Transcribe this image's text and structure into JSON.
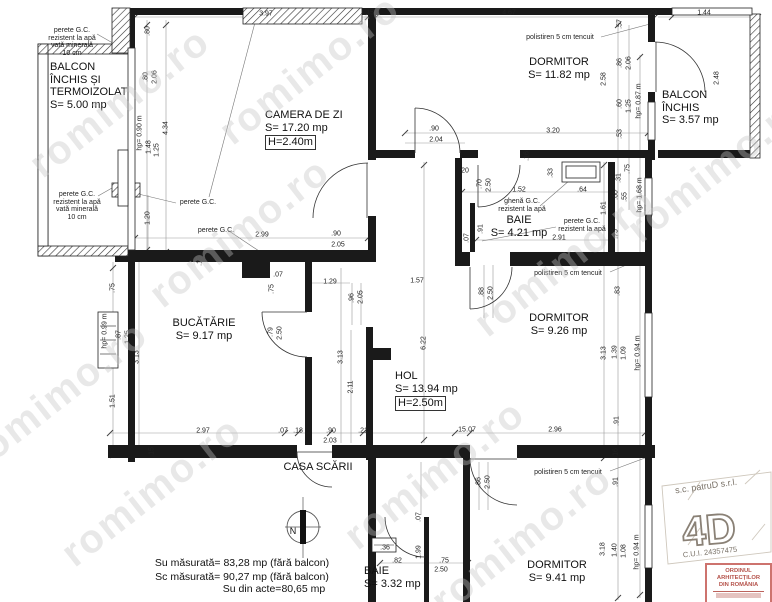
{
  "plan": {
    "watermark": "romimo.ro",
    "compass_label": "N",
    "summary": [
      "Su măsurată= 83,28 mp (fără balcon)",
      "Sc măsurată= 90,27 mp (fără balcon)",
      "Su din acte=80,65 mp"
    ],
    "stamp": {
      "company": "s.c. patruD s.r.l.",
      "logo": "4D",
      "cui": "C.U.I. 24357475",
      "seal_line1": "ORDINUL ARHITECȚILOR",
      "seal_line2": "DIN ROMÂNIA",
      "seal_color": "#b5524a"
    },
    "rooms": [
      {
        "id": "balcon-stanga",
        "lines": [
          "BALCON",
          "ÎNCHIS ȘI",
          "TERMOIZOLAT",
          "S= 5.00 mp"
        ],
        "x": 50,
        "y": 61,
        "align": "left"
      },
      {
        "id": "camera-de-zi",
        "lines": [
          "CAMERA DE ZI",
          "S= 17.20 mp"
        ],
        "boxed": "H=2.40m",
        "x": 265,
        "y": 109,
        "align": "left"
      },
      {
        "id": "dormitor-1",
        "lines": [
          "DORMITOR",
          "S= 11.82 mp"
        ],
        "x": 559,
        "y": 56
      },
      {
        "id": "balcon-dreapta",
        "lines": [
          "BALCON",
          "ÎNCHIS",
          "S= 3.57 mp"
        ],
        "x": 662,
        "y": 89,
        "align": "left"
      },
      {
        "id": "baie-1",
        "lines": [
          "BAIE",
          "S= 4.21 mp"
        ],
        "x": 519,
        "y": 214
      },
      {
        "id": "bucatarie",
        "lines": [
          "BUCĂTĂRIE",
          "S= 9.17 mp"
        ],
        "x": 204,
        "y": 317
      },
      {
        "id": "hol",
        "lines": [
          "HOL",
          "S= 13.94 mp"
        ],
        "boxed": "H=2.50m",
        "x": 395,
        "y": 370,
        "align": "left"
      },
      {
        "id": "dormitor-2",
        "lines": [
          "DORMITOR",
          "S= 9.26 mp"
        ],
        "x": 559,
        "y": 312
      },
      {
        "id": "casa-scarii",
        "lines": [
          "CASA SCĂRII"
        ],
        "x": 318,
        "y": 461
      },
      {
        "id": "baie-2",
        "lines": [
          "BAIE",
          "S= 3.32 mp"
        ],
        "x": 364,
        "y": 565,
        "align": "left"
      },
      {
        "id": "dormitor-3",
        "lines": [
          "DORMITOR",
          "S= 9.41 mp"
        ],
        "x": 557,
        "y": 559
      }
    ],
    "notes": [
      {
        "lines": [
          "perete G.C.",
          "rezistent la apă",
          "vată minerală",
          "10 cm"
        ],
        "x": 72,
        "y": 27
      },
      {
        "lines": [
          "perete G.C.",
          "rezistent la apă",
          "vată minerală",
          "10 cm"
        ],
        "x": 77,
        "y": 191
      },
      {
        "lines": [
          "perete G.C."
        ],
        "x": 198,
        "y": 199
      },
      {
        "lines": [
          "perete G.C."
        ],
        "x": 216,
        "y": 227
      },
      {
        "lines": [
          "polistiren 5 cm tencuit"
        ],
        "x": 560,
        "y": 34
      },
      {
        "lines": [
          "ghenă G.C.",
          "rezistent la apă"
        ],
        "x": 522,
        "y": 198
      },
      {
        "lines": [
          "perete G.C.",
          "rezistent la apă"
        ],
        "x": 582,
        "y": 218
      },
      {
        "lines": [
          "polistiren 5 cm tencuit"
        ],
        "x": 568,
        "y": 270
      },
      {
        "lines": [
          "polistiren 5 cm tencuit"
        ],
        "x": 568,
        "y": 469
      }
    ],
    "dims": [
      [
        "3.97",
        266,
        14,
        0
      ],
      [
        ".15",
        369,
        13,
        0
      ],
      [
        "4.67",
        509,
        13,
        0
      ],
      [
        ".29",
        652,
        13,
        0
      ],
      [
        "1.44",
        704,
        13,
        0
      ],
      [
        ".57",
        620,
        24,
        1
      ],
      [
        "2.48",
        717,
        78,
        1
      ],
      [
        ".80",
        148,
        31,
        1
      ],
      [
        ".80",
        146,
        77,
        1
      ],
      [
        "2.06",
        155,
        77,
        1
      ],
      [
        "hp= 0.90 m",
        140,
        133,
        1
      ],
      [
        "1.48",
        149,
        147,
        1
      ],
      [
        "1.25",
        157,
        150,
        1
      ],
      [
        "4.34",
        166,
        128,
        1
      ],
      [
        "2.58",
        604,
        79,
        1
      ],
      [
        ".86",
        620,
        63,
        1
      ],
      [
        "2.06",
        629,
        63,
        1
      ],
      [
        ".60",
        620,
        104,
        1
      ],
      [
        "1.25",
        629,
        106,
        1
      ],
      [
        ".53",
        620,
        134,
        1
      ],
      [
        "hp= 0.87 m",
        639,
        101,
        1
      ],
      [
        ".90",
        434,
        129,
        0
      ],
      [
        "2.04",
        436,
        140,
        0
      ],
      [
        "3.20",
        553,
        131,
        0
      ],
      [
        ".16",
        527,
        156,
        1
      ],
      [
        ".75",
        628,
        169,
        1
      ],
      [
        ".31",
        619,
        178,
        1
      ],
      [
        ".60",
        616,
        195,
        1
      ],
      [
        ".55",
        625,
        197,
        1
      ],
      [
        "hp= 1.68 m",
        640,
        195,
        1
      ],
      [
        ".20",
        464,
        171,
        0
      ],
      [
        ".70",
        480,
        184,
        1
      ],
      [
        "2.50",
        489,
        185,
        1
      ],
      [
        "1.52",
        519,
        190,
        0
      ],
      [
        ".64",
        582,
        190,
        0
      ],
      [
        ".33",
        551,
        173,
        1
      ],
      [
        "1.61",
        604,
        208,
        1
      ],
      [
        ".91",
        481,
        229,
        1
      ],
      [
        ".07",
        467,
        238,
        1
      ],
      [
        "2.91",
        559,
        238,
        0
      ],
      [
        ".75",
        616,
        234,
        1
      ],
      [
        "2.99",
        262,
        235,
        0
      ],
      [
        ".90",
        336,
        234,
        0
      ],
      [
        "2.05",
        338,
        245,
        0
      ],
      [
        ".15",
        200,
        261,
        1
      ],
      [
        "1.20",
        148,
        218,
        1
      ],
      [
        ".75",
        113,
        288,
        1
      ],
      [
        ".87",
        119,
        335,
        1
      ],
      [
        "1.25",
        128,
        337,
        1
      ],
      [
        "hp= 0.99 m",
        105,
        331,
        1
      ],
      [
        "3.13",
        137,
        357,
        1
      ],
      [
        "1.51",
        113,
        401,
        1
      ],
      [
        ".07",
        278,
        275,
        0
      ],
      [
        ".75",
        272,
        289,
        1
      ],
      [
        ".79",
        271,
        332,
        1
      ],
      [
        "2.50",
        280,
        333,
        1
      ],
      [
        "1.29",
        330,
        282,
        0
      ],
      [
        "1.57",
        417,
        281,
        0
      ],
      [
        ".96",
        352,
        298,
        1
      ],
      [
        "2.05",
        361,
        297,
        1
      ],
      [
        "6.22",
        424,
        343,
        1
      ],
      [
        "3.13",
        341,
        357,
        1
      ],
      [
        "2.11",
        351,
        387,
        1
      ],
      [
        ".88",
        482,
        292,
        1
      ],
      [
        "2.50",
        491,
        293,
        1
      ],
      [
        ".83",
        618,
        291,
        1
      ],
      [
        "3.13",
        604,
        353,
        1
      ],
      [
        "1.39",
        615,
        352,
        1
      ],
      [
        "1.09",
        624,
        353,
        1
      ],
      [
        "hp= 0.94 m",
        638,
        353,
        1
      ],
      [
        ".91",
        617,
        421,
        1
      ],
      [
        "2.96",
        555,
        430,
        0
      ],
      [
        ".15",
        461,
        430,
        0
      ],
      [
        ".07",
        471,
        430,
        0
      ],
      [
        ".16",
        616,
        453,
        1
      ],
      [
        "2.97",
        203,
        431,
        0
      ],
      [
        ".07",
        283,
        431,
        0
      ],
      [
        ".18",
        298,
        431,
        0
      ],
      [
        ".90",
        331,
        431,
        0
      ],
      [
        "2.03",
        330,
        441,
        0
      ],
      [
        ".21",
        363,
        431,
        0
      ],
      [
        ".15",
        152,
        452,
        1
      ],
      [
        ".86",
        479,
        482,
        1
      ],
      [
        "2.50",
        488,
        482,
        1
      ],
      [
        ".91",
        616,
        482,
        1
      ],
      [
        "3.18",
        603,
        549,
        1
      ],
      [
        "1.40",
        615,
        550,
        1
      ],
      [
        "1.08",
        624,
        551,
        1
      ],
      [
        "hp= 0.94 m",
        637,
        552,
        1
      ],
      [
        ".07",
        419,
        517,
        1
      ],
      [
        "1.99",
        419,
        552,
        1
      ],
      [
        ".36",
        385,
        548,
        0
      ],
      [
        ".82",
        397,
        561,
        0
      ],
      [
        ".75",
        444,
        561,
        0
      ],
      [
        "2.50",
        441,
        570,
        0
      ]
    ],
    "watermarks": [
      [
        120,
        103
      ],
      [
        310,
        70
      ],
      [
        718,
        168
      ],
      [
        565,
        262
      ],
      [
        58,
        396
      ],
      [
        152,
        492
      ],
      [
        522,
        540
      ],
      [
        240,
        233
      ],
      [
        435,
        475
      ]
    ],
    "summary_pos": [
      [
        242,
        563
      ],
      [
        242,
        577
      ],
      [
        274,
        589
      ]
    ]
  }
}
